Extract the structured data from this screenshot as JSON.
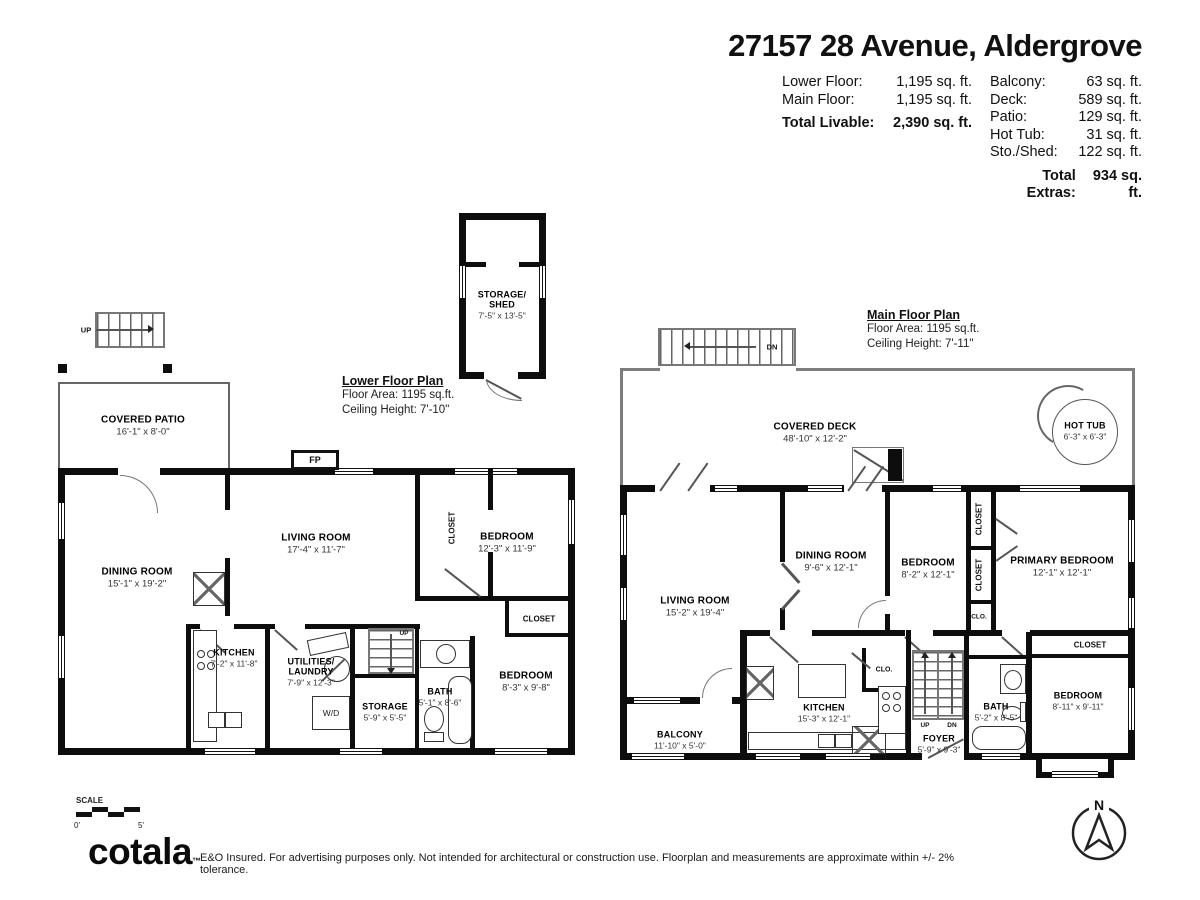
{
  "header": {
    "title": "27157 28 Avenue, Aldergrove",
    "livable_rows": [
      {
        "label": "Lower Floor:",
        "value": "1,195 sq. ft."
      },
      {
        "label": "Main Floor:",
        "value": "1,195 sq. ft."
      }
    ],
    "total_livable_label": "Total Livable:",
    "total_livable_value": "2,390 sq. ft.",
    "extras_rows": [
      {
        "label": "Balcony:",
        "value": "63 sq. ft."
      },
      {
        "label": "Deck:",
        "value": "589 sq. ft."
      },
      {
        "label": "Patio:",
        "value": "129 sq. ft."
      },
      {
        "label": "Hot Tub:",
        "value": "31 sq. ft."
      },
      {
        "label": "Sto./Shed:",
        "value": "122 sq. ft."
      }
    ],
    "total_extras_label": "Total Extras:",
    "total_extras_value": "934 sq. ft."
  },
  "shed": {
    "line1": "STORAGE/",
    "line2": "SHED",
    "dims": "7'-5\" x 13'-5\""
  },
  "lower": {
    "plan_title": "Lower Floor Plan",
    "floor_area": "Floor Area: 1195 sq.ft.",
    "ceiling": "Ceiling Height: 7'-10\"",
    "rooms": {
      "patio": {
        "name": "COVERED PATIO",
        "dims": "16'-1\" x 8'-0\""
      },
      "dining": {
        "name": "DINING ROOM",
        "dims": "15'-1\" x 19'-2\""
      },
      "living": {
        "name": "LIVING ROOM",
        "dims": "17'-4\" x 11'-7\""
      },
      "bedroom1": {
        "name": "BEDROOM",
        "dims": "12'-3\" x 11'-9\""
      },
      "bedroom2": {
        "name": "BEDROOM",
        "dims": "8'-3\" x 9'-8\""
      },
      "kitchen": {
        "name": "KITCHEN",
        "dims": "7'-2\" x 11'-8\""
      },
      "utilities": {
        "name": "UTILITIES/",
        "name2": "LAUNDRY",
        "dims": "7'-9\" x 12'-3\""
      },
      "storage": {
        "name": "STORAGE",
        "dims": "5'-9\" x 5'-5\""
      },
      "bath": {
        "name": "BATH",
        "dims": "5'-1\" x 8'-6\""
      },
      "closet_hall": "CLOSET",
      "closet_bed": "CLOSET",
      "fp": "FP",
      "wd": "W/D",
      "up_outside": "UP",
      "up_inside": "UP"
    }
  },
  "main": {
    "plan_title": "Main Floor Plan",
    "floor_area": "Floor Area: 1195 sq.ft.",
    "ceiling": "Ceiling Height: 7'-11\"",
    "rooms": {
      "deck": {
        "name": "COVERED DECK",
        "dims": "48'-10\" x 12'-2\""
      },
      "hottub": {
        "name": "HOT TUB",
        "dims": "6'-3\" x 6'-3\""
      },
      "living": {
        "name": "LIVING ROOM",
        "dims": "15'-2\" x 19'-4\""
      },
      "dining": {
        "name": "DINING ROOM",
        "dims": "9'-6\" x 12'-1\""
      },
      "bedroom1": {
        "name": "BEDROOM",
        "dims": "8'-2\" x 12'-1\""
      },
      "primary": {
        "name": "PRIMARY BEDROOM",
        "dims": "12'-1\" x 12'-1\""
      },
      "bedroom2": {
        "name": "BEDROOM",
        "dims": "8'-11\" x 9'-11\""
      },
      "bath": {
        "name": "BATH",
        "dims": "5'-2\" x 8'-5\""
      },
      "foyer": {
        "name": "FOYER",
        "dims": "5'-9\" x 9'-3\""
      },
      "kitchen": {
        "name": "KITCHEN",
        "dims": "15'-3\" x 12'-1\""
      },
      "balcony": {
        "name": "BALCONY",
        "dims": "11'-10\" x 5'-0\""
      },
      "closet_a": "CLOSET",
      "closet_b": "CLOSET",
      "clo_a": "CLO.",
      "clo_b": "CLO.",
      "closet_bed": "CLOSET",
      "dn_top": "DN",
      "up_stairs": "UP",
      "dn_stairs": "DN"
    }
  },
  "footer": {
    "scale_label": "SCALE",
    "scale_start": "0'",
    "scale_end": "5'",
    "logo": "cotala",
    "logo_tm": "™",
    "disclaimer": "E&O Insured. For advertising purposes only. Not intended for architectural or construction use. Floorplan and measurements are approximate within +/- 2% tolerance.",
    "compass_n": "N"
  }
}
